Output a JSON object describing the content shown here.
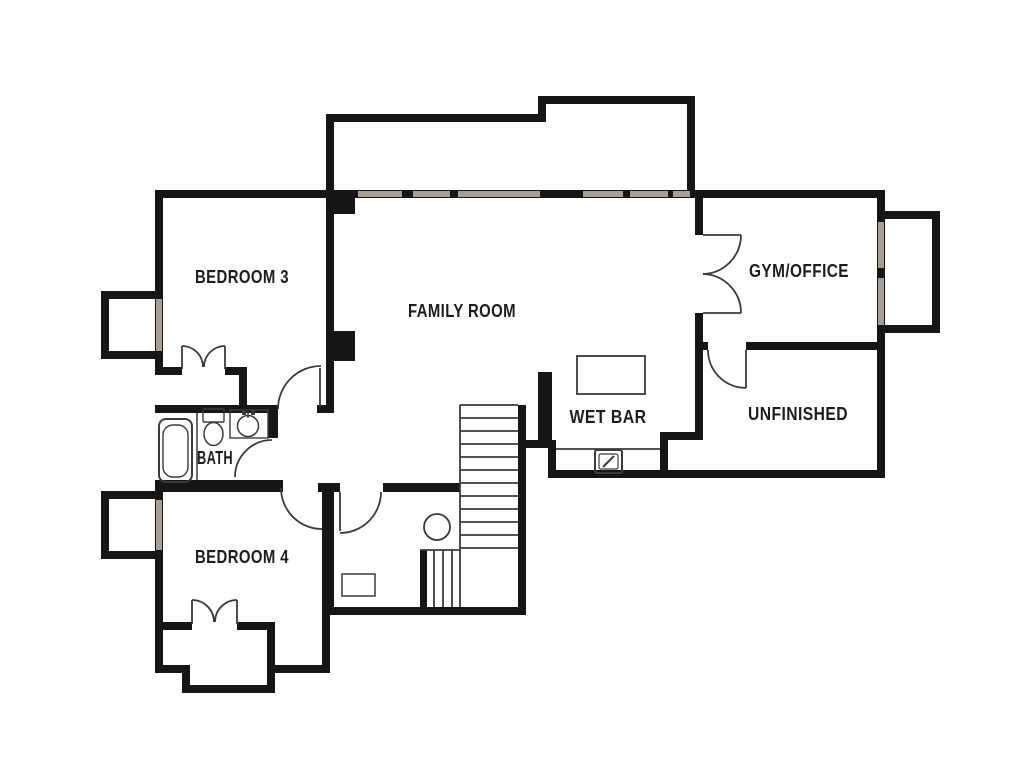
{
  "meta": {
    "type": "floor-plan",
    "floor": "upper-level",
    "background": "#ffffff"
  },
  "colors": {
    "wall": "#161616",
    "thin": "#3b3b3b",
    "window": "#a89f94",
    "label": "#1d1d1d",
    "background": "#ffffff"
  },
  "rooms": [
    {
      "id": "bedroom-3",
      "label": "BEDROOM 3",
      "x": 242,
      "y": 283,
      "size": 18,
      "len": 94
    },
    {
      "id": "family-room",
      "label": "FAMILY ROOM",
      "x": 462,
      "y": 317,
      "size": 18,
      "len": 108
    },
    {
      "id": "gym-office",
      "label": "GYM/OFFICE",
      "x": 799,
      "y": 277,
      "size": 18,
      "len": 100
    },
    {
      "id": "unfinished",
      "label": "UNFINISHED",
      "x": 798,
      "y": 420,
      "size": 18,
      "len": 100
    },
    {
      "id": "wet-bar",
      "label": "WET BAR",
      "x": 608,
      "y": 423,
      "size": 18,
      "len": 77
    },
    {
      "id": "bath",
      "label": "BATH",
      "x": 215,
      "y": 464,
      "size": 18,
      "len": 36
    },
    {
      "id": "bedroom-4",
      "label": "BEDROOM 4",
      "x": 242,
      "y": 563,
      "size": 18,
      "len": 94
    }
  ],
  "plan": {
    "walls": [
      {
        "n": "deck-left-top-wall",
        "x": 326,
        "y": 114,
        "w": 220,
        "h": 8
      },
      {
        "n": "deck-left-west-wall",
        "x": 326,
        "y": 114,
        "w": 8,
        "h": 84
      },
      {
        "n": "deck-step-wall",
        "x": 538,
        "y": 96,
        "w": 8,
        "h": 20
      },
      {
        "n": "deck-right-top-wall",
        "x": 538,
        "y": 96,
        "w": 157,
        "h": 8
      },
      {
        "n": "deck-right-east-wall",
        "x": 687,
        "y": 96,
        "w": 8,
        "h": 102
      },
      {
        "n": "family-window-wall",
        "x": 335,
        "y": 190,
        "w": 360,
        "h": 8
      },
      {
        "n": "bedroom3-north-wall",
        "x": 155,
        "y": 190,
        "w": 180,
        "h": 8
      },
      {
        "n": "gym-north-wall",
        "x": 695,
        "y": 190,
        "w": 190,
        "h": 8
      },
      {
        "n": "east-exterior-wall",
        "x": 877,
        "y": 198,
        "w": 8,
        "h": 280
      },
      {
        "n": "gym-bay-top-wall",
        "x": 885,
        "y": 211,
        "w": 55,
        "h": 8
      },
      {
        "n": "gym-bay-east-wall",
        "x": 932,
        "y": 211,
        "w": 8,
        "h": 122
      },
      {
        "n": "gym-bay-bottom-wall",
        "x": 885,
        "y": 325,
        "w": 55,
        "h": 8
      },
      {
        "n": "gym-west-wall-upper",
        "x": 695,
        "y": 198,
        "w": 8,
        "h": 37
      },
      {
        "n": "gym-west-wall-lower",
        "x": 695,
        "y": 313,
        "w": 8,
        "h": 37
      },
      {
        "n": "gym-south-wall-west",
        "x": 695,
        "y": 342,
        "w": 13,
        "h": 8
      },
      {
        "n": "gym-south-wall-east",
        "x": 746,
        "y": 342,
        "w": 139,
        "h": 8
      },
      {
        "n": "family-east-wall",
        "x": 695,
        "y": 350,
        "w": 8,
        "h": 90
      },
      {
        "n": "family-south-wall",
        "x": 660,
        "y": 432,
        "w": 43,
        "h": 8
      },
      {
        "n": "unfinished-west-wall",
        "x": 660,
        "y": 432,
        "w": 8,
        "h": 46
      },
      {
        "n": "south-exterior-wall",
        "x": 548,
        "y": 470,
        "w": 337,
        "h": 8
      },
      {
        "n": "wetbar-west-wall",
        "x": 548,
        "y": 440,
        "w": 8,
        "h": 38
      },
      {
        "n": "wetbar-top-wall",
        "x": 526,
        "y": 440,
        "w": 22,
        "h": 8
      },
      {
        "n": "stair-east-wall",
        "x": 518,
        "y": 405,
        "w": 8,
        "h": 210
      },
      {
        "n": "stair-top-stub-wall",
        "x": 538,
        "y": 372,
        "w": 14,
        "h": 76
      },
      {
        "n": "stair-south-wall",
        "x": 322,
        "y": 607,
        "w": 204,
        "h": 8
      },
      {
        "n": "bedroom3-west-wall",
        "x": 155,
        "y": 190,
        "w": 8,
        "h": 185
      },
      {
        "n": "bed3-bay-top-wall",
        "x": 101,
        "y": 291,
        "w": 62,
        "h": 8
      },
      {
        "n": "bed3-bay-west-wall",
        "x": 101,
        "y": 291,
        "w": 8,
        "h": 68
      },
      {
        "n": "bed3-bay-bottom-wall",
        "x": 101,
        "y": 351,
        "w": 62,
        "h": 8
      },
      {
        "n": "bedroom3-east-wall",
        "x": 326,
        "y": 198,
        "w": 8,
        "h": 215
      },
      {
        "n": "family-pilaster-1",
        "x": 334,
        "y": 198,
        "w": 21,
        "h": 16
      },
      {
        "n": "family-pilaster-2",
        "x": 334,
        "y": 331,
        "w": 21,
        "h": 30
      },
      {
        "n": "bedroom3-south-wall-west",
        "x": 155,
        "y": 367,
        "w": 27,
        "h": 8
      },
      {
        "n": "bedroom3-south-wall-east",
        "x": 225,
        "y": 367,
        "w": 22,
        "h": 8
      },
      {
        "n": "closet3-east-wall",
        "x": 239,
        "y": 367,
        "w": 8,
        "h": 46
      },
      {
        "n": "bath-north-wall",
        "x": 155,
        "y": 405,
        "w": 122,
        "h": 8
      },
      {
        "n": "bed3-door-jamb",
        "x": 317,
        "y": 405,
        "w": 9,
        "h": 8
      },
      {
        "n": "bath-east-wall",
        "x": 268,
        "y": 405,
        "w": 10,
        "h": 33
      },
      {
        "n": "bath-south-wall",
        "x": 155,
        "y": 480,
        "w": 128,
        "h": 12
      },
      {
        "n": "hall-door-stub",
        "x": 318,
        "y": 483,
        "w": 22,
        "h": 9
      },
      {
        "n": "laundry-north-wall",
        "x": 383,
        "y": 483,
        "w": 77,
        "h": 9
      },
      {
        "n": "bedroom4-west-wall",
        "x": 155,
        "y": 480,
        "w": 8,
        "h": 193
      },
      {
        "n": "bed4-bay-top-wall",
        "x": 101,
        "y": 491,
        "w": 62,
        "h": 8
      },
      {
        "n": "bed4-bay-west-wall",
        "x": 101,
        "y": 491,
        "w": 8,
        "h": 68
      },
      {
        "n": "bed4-bay-bottom-wall",
        "x": 101,
        "y": 551,
        "w": 62,
        "h": 8
      },
      {
        "n": "bedroom4-east-wall",
        "x": 322,
        "y": 483,
        "w": 12,
        "h": 132
      },
      {
        "n": "bedroom4-east-lower-wall",
        "x": 322,
        "y": 607,
        "w": 8,
        "h": 66
      },
      {
        "n": "alcove-south-wall",
        "x": 267,
        "y": 665,
        "w": 63,
        "h": 8
      },
      {
        "n": "closet4-east-wall",
        "x": 267,
        "y": 622,
        "w": 8,
        "h": 71
      },
      {
        "n": "closet4-bottom-wall",
        "x": 182,
        "y": 685,
        "w": 93,
        "h": 8
      },
      {
        "n": "closet4-step-wall",
        "x": 182,
        "y": 665,
        "w": 8,
        "h": 28
      },
      {
        "n": "closet4-west-step-wall",
        "x": 155,
        "y": 665,
        "w": 35,
        "h": 8
      },
      {
        "n": "bedroom4-south-wall-west",
        "x": 155,
        "y": 622,
        "w": 37,
        "h": 8
      },
      {
        "n": "bedroom4-south-wall-east",
        "x": 237,
        "y": 622,
        "w": 38,
        "h": 8
      },
      {
        "n": "lower-stair-west-wall",
        "x": 420,
        "y": 550,
        "w": 7,
        "h": 57
      }
    ],
    "windows": [
      {
        "n": "family-window-1",
        "x": 358,
        "y": 191,
        "w": 44,
        "h": 6
      },
      {
        "n": "family-window-2",
        "x": 413,
        "y": 191,
        "w": 37,
        "h": 6
      },
      {
        "n": "family-window-3",
        "x": 458,
        "y": 191,
        "w": 82,
        "h": 6
      },
      {
        "n": "family-window-4",
        "x": 583,
        "y": 191,
        "w": 40,
        "h": 6
      },
      {
        "n": "family-window-5",
        "x": 630,
        "y": 191,
        "w": 38,
        "h": 6
      },
      {
        "n": "family-window-6",
        "x": 673,
        "y": 191,
        "w": 17,
        "h": 6
      },
      {
        "n": "bedroom3-bay-window",
        "x": 156,
        "y": 299,
        "w": 6,
        "h": 52
      },
      {
        "n": "bedroom4-bay-window",
        "x": 156,
        "y": 500,
        "w": 6,
        "h": 50
      },
      {
        "n": "gym-bay-window-upper",
        "x": 878,
        "y": 222,
        "w": 6,
        "h": 46
      },
      {
        "n": "gym-bay-window-lower",
        "x": 878,
        "y": 278,
        "w": 6,
        "h": 47
      }
    ],
    "outline_rects": [
      {
        "n": "bathtub-outer",
        "x": 159,
        "y": 419,
        "w": 33,
        "h": 63,
        "rx": 7,
        "s": 2
      },
      {
        "n": "bathtub-inner",
        "x": 163,
        "y": 425,
        "w": 25,
        "h": 52,
        "rx": 10,
        "s": 1.4
      },
      {
        "n": "toilet-tank",
        "x": 203,
        "y": 409,
        "w": 21,
        "h": 13,
        "rx": 1,
        "s": 1.4
      },
      {
        "n": "bath-sink-counter",
        "x": 230,
        "y": 410,
        "w": 38,
        "h": 28,
        "rx": 0,
        "s": 1.4
      },
      {
        "n": "wetbar-island",
        "x": 577,
        "y": 356,
        "w": 68,
        "h": 38,
        "rx": 0,
        "s": 1.8
      },
      {
        "n": "laundry-vent",
        "x": 342,
        "y": 574,
        "w": 33,
        "h": 22,
        "rx": 0,
        "s": 1.5
      },
      {
        "n": "wetbar-sink-outer",
        "x": 595,
        "y": 450,
        "w": 27,
        "h": 23,
        "rx": 2,
        "s": 2
      },
      {
        "n": "wetbar-sink-inner",
        "x": 599,
        "y": 454,
        "w": 19,
        "h": 15,
        "rx": 2,
        "s": 1.2
      }
    ],
    "circles": [
      {
        "n": "bath-sink-basin",
        "cx": 248,
        "cy": 426,
        "r": 10.5,
        "s": 1.5
      },
      {
        "n": "landing-fixture",
        "cx": 437,
        "cy": 527,
        "r": 13,
        "s": 1.8
      }
    ],
    "ellipses": [
      {
        "n": "toilet-bowl",
        "cx": 213.5,
        "cy": 434,
        "rx": 9.5,
        "ry": 11.5,
        "s": 1.5
      }
    ],
    "lines": [
      {
        "n": "stair-west-edge",
        "x1": 460,
        "y1": 405,
        "x2": 460,
        "y2": 607,
        "s": 1.8
      },
      {
        "n": "stair-tread",
        "x1": 460,
        "y1": 405,
        "x2": 518,
        "y2": 405,
        "s": 1.8
      },
      {
        "n": "stair-tread",
        "x1": 460,
        "y1": 418,
        "x2": 518,
        "y2": 418,
        "s": 1.8
      },
      {
        "n": "stair-tread",
        "x1": 460,
        "y1": 431,
        "x2": 518,
        "y2": 431,
        "s": 1.8
      },
      {
        "n": "stair-tread",
        "x1": 460,
        "y1": 444,
        "x2": 518,
        "y2": 444,
        "s": 1.8
      },
      {
        "n": "stair-tread",
        "x1": 460,
        "y1": 457,
        "x2": 518,
        "y2": 457,
        "s": 1.8
      },
      {
        "n": "stair-tread",
        "x1": 460,
        "y1": 470,
        "x2": 518,
        "y2": 470,
        "s": 1.8
      },
      {
        "n": "stair-tread",
        "x1": 460,
        "y1": 483,
        "x2": 518,
        "y2": 483,
        "s": 1.8
      },
      {
        "n": "stair-tread",
        "x1": 460,
        "y1": 496,
        "x2": 518,
        "y2": 496,
        "s": 1.8
      },
      {
        "n": "stair-tread",
        "x1": 460,
        "y1": 509,
        "x2": 518,
        "y2": 509,
        "s": 1.8
      },
      {
        "n": "stair-tread",
        "x1": 460,
        "y1": 522,
        "x2": 518,
        "y2": 522,
        "s": 1.8
      },
      {
        "n": "stair-tread",
        "x1": 460,
        "y1": 535,
        "x2": 518,
        "y2": 535,
        "s": 1.8
      },
      {
        "n": "stair-tread",
        "x1": 460,
        "y1": 548,
        "x2": 518,
        "y2": 548,
        "s": 1.8
      },
      {
        "n": "landing-edge",
        "x1": 420,
        "y1": 550,
        "x2": 460,
        "y2": 550,
        "s": 1.8
      },
      {
        "n": "lower-stair-tread",
        "x1": 434,
        "y1": 550,
        "x2": 434,
        "y2": 607,
        "s": 1.8
      },
      {
        "n": "lower-stair-tread",
        "x1": 443,
        "y1": 550,
        "x2": 443,
        "y2": 607,
        "s": 1.8
      },
      {
        "n": "lower-stair-tread",
        "x1": 452,
        "y1": 550,
        "x2": 452,
        "y2": 607,
        "s": 1.8
      },
      {
        "n": "wetbar-counter-edge",
        "x1": 556,
        "y1": 449,
        "x2": 660,
        "y2": 449,
        "s": 1.8
      },
      {
        "n": "tub-partition",
        "x1": 197,
        "y1": 413,
        "x2": 197,
        "y2": 480,
        "s": 1.5
      },
      {
        "n": "bed3-door-leaf",
        "x1": 320,
        "y1": 368,
        "x2": 320,
        "y2": 407,
        "s": 1.8
      },
      {
        "n": "laundry-door-leaf",
        "x1": 340,
        "y1": 492,
        "x2": 340,
        "y2": 531,
        "s": 1.8
      },
      {
        "n": "unfinished-door-leaf",
        "x1": 746,
        "y1": 350,
        "x2": 746,
        "y2": 388,
        "s": 1.8
      },
      {
        "n": "gym-door-leaf-top",
        "x1": 703,
        "y1": 235,
        "x2": 741,
        "y2": 235,
        "s": 1.8
      },
      {
        "n": "gym-door-leaf-bottom",
        "x1": 703,
        "y1": 313,
        "x2": 741,
        "y2": 313,
        "s": 1.8
      },
      {
        "n": "closet3-door-leaf",
        "x1": 182,
        "y1": 346,
        "x2": 182,
        "y2": 369,
        "s": 1.8
      },
      {
        "n": "closet3-door-leaf",
        "x1": 225,
        "y1": 346,
        "x2": 225,
        "y2": 369,
        "s": 1.8
      },
      {
        "n": "closet4-door-leaf",
        "x1": 192,
        "y1": 600,
        "x2": 192,
        "y2": 624,
        "s": 1.8
      },
      {
        "n": "closet4-door-leaf",
        "x1": 237,
        "y1": 600,
        "x2": 237,
        "y2": 624,
        "s": 1.8
      },
      {
        "n": "wetbar-faucet",
        "x1": 603,
        "y1": 467,
        "x2": 614,
        "y2": 456,
        "s": 2
      },
      {
        "n": "bath-faucet-stem",
        "x1": 248,
        "y1": 411,
        "x2": 248,
        "y2": 418,
        "s": 1.5
      }
    ],
    "arcs": [
      {
        "n": "bedroom3-door-swing",
        "d": "M 278,409 A 43,43 0 0 1 321,366"
      },
      {
        "n": "bath-door-swing",
        "d": "M 272,440 A 37,37 0 0 0 235,477"
      },
      {
        "n": "bedroom4-door-swing",
        "d": "M 281,488 A 41,41 0 0 0 322,529"
      },
      {
        "n": "laundry-door-swing",
        "d": "M 381,492 A 41,41 0 0 1 340,533"
      },
      {
        "n": "unfinished-door-swing",
        "d": "M 708,350 A 38,38 0 0 0 746,388"
      },
      {
        "n": "gym-french-door-top-swing",
        "d": "M 741,235 A 39,39 0 0 1 703,274"
      },
      {
        "n": "gym-french-door-bottom-swing",
        "d": "M 741,313 A 39,39 0 0 0 703,274"
      },
      {
        "n": "closet3-door-swing-left",
        "d": "M 182,346 A 21,21 0 0 1 203,367"
      },
      {
        "n": "closet3-door-swing-right",
        "d": "M 225,346 A 21,21 0 0 0 204,367"
      },
      {
        "n": "closet4-door-swing-left",
        "d": "M 192,600 A 22,22 0 0 1 214,622"
      },
      {
        "n": "closet4-door-swing-right",
        "d": "M 237,600 A 22,22 0 0 0 215,622"
      }
    ],
    "fills": [
      {
        "n": "bath-faucet-knob",
        "x": 242,
        "y": 410,
        "w": 4,
        "h": 5
      },
      {
        "n": "bath-faucet-knob",
        "x": 251,
        "y": 410,
        "w": 4,
        "h": 5
      }
    ]
  }
}
